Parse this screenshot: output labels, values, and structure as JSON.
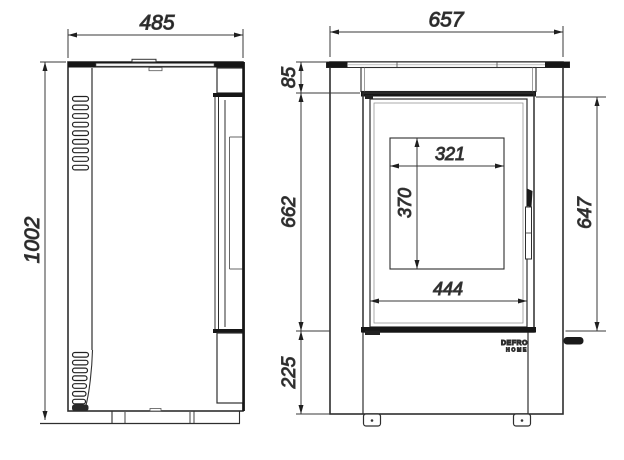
{
  "drawing": {
    "type": "technical dimension drawing, freestanding stove, side and front views",
    "line_color": "#2e2e2e",
    "band_color": "#161616",
    "dimensions": {
      "side_overall_width": "485",
      "front_overall_width": "657",
      "overall_height": "1002",
      "top_panel_height": "85",
      "door_section_height": "662",
      "base_height": "225",
      "glass_opening_width": "321",
      "glass_opening_height": "370",
      "door_glass_width": "444",
      "door_height": "647"
    },
    "brand_logo": {
      "line1": "DEFRO",
      "line2": "HOME"
    }
  }
}
